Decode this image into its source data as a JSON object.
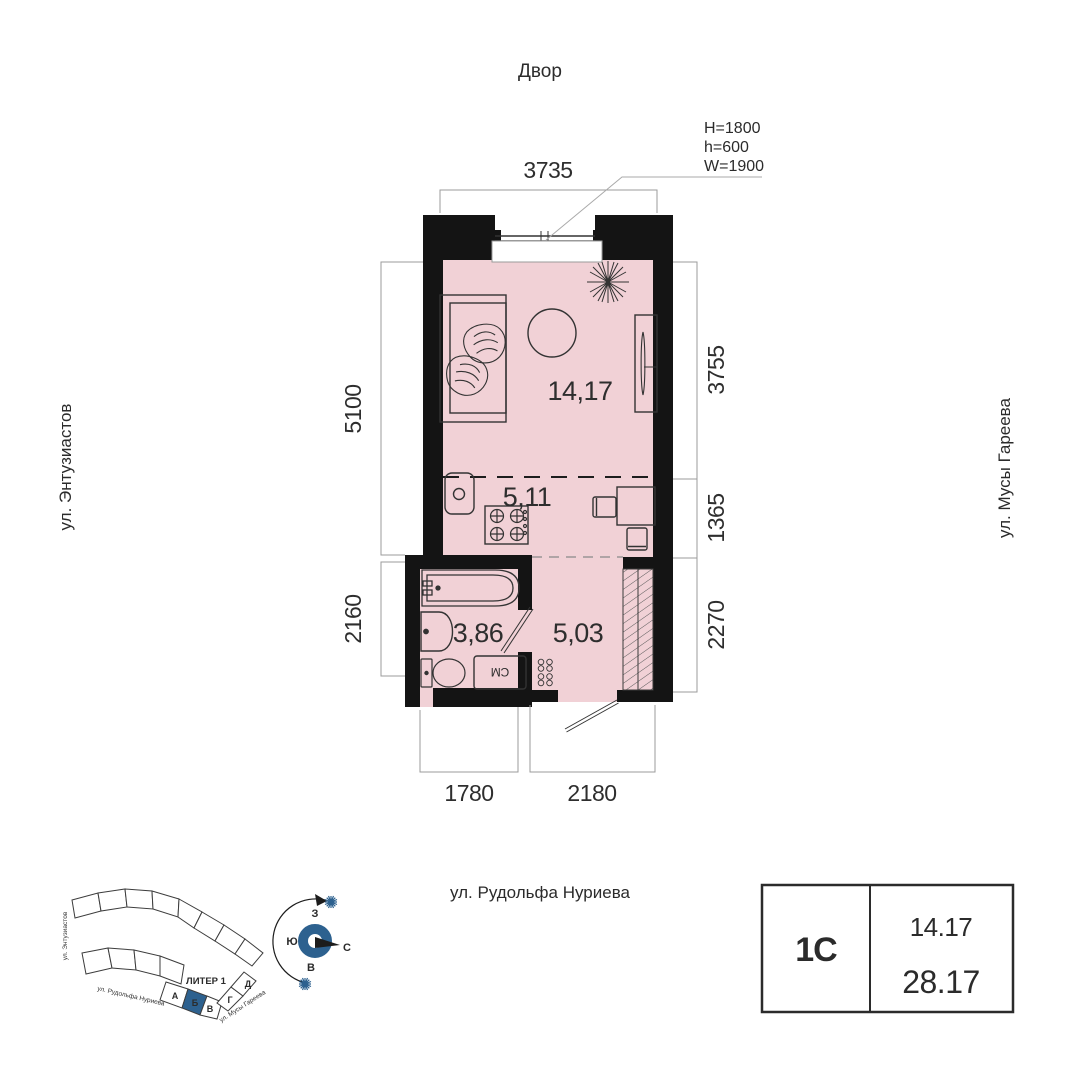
{
  "plan": {
    "courtyard_label": "Двор",
    "street_left": "ул. Энтузиастов",
    "street_right": "ул. Мусы Гареева",
    "street_bottom": "ул. Рудольфа Нуриева",
    "window_spec": {
      "line1": "H=1800",
      "line2": "h=600",
      "line3": "W=1900"
    },
    "dims": {
      "top": "3735",
      "left_upper": "5100",
      "left_lower": "2160",
      "right_upper": "3755",
      "right_mid": "1365",
      "right_lower": "2270",
      "bottom_left": "1780",
      "bottom_right": "2180"
    },
    "areas": {
      "living": "14,17",
      "kitchen": "5,11",
      "bath": "3,86",
      "hall": "5,03"
    },
    "washer": "СМ"
  },
  "site_plan": {
    "building_label": "ЛИТЕР 1",
    "sections": [
      "А",
      "Б",
      "В",
      "Г",
      "Д"
    ],
    "highlighted_section": "Б",
    "street_left": "ул. Энтузиастов",
    "street_bottom": "ул. Рудольфа Нуриева",
    "street_right": "ул. Мусы Гареева"
  },
  "compass": {
    "north": "С",
    "south": "Ю",
    "west": "З",
    "east": "В"
  },
  "info_table": {
    "unit_type": "1С",
    "living_area": "14.17",
    "total_area": "28.17"
  },
  "colors": {
    "floor_fill": "#f1d1d6",
    "wall": "#141414",
    "accent_blue": "#2d618f",
    "dim_line": "#9b9b9b"
  }
}
